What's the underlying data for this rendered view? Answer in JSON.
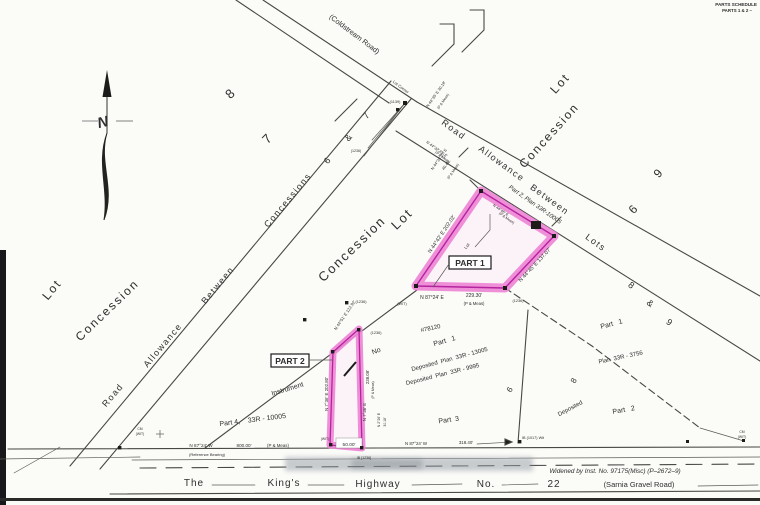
{
  "colors": {
    "highlight_band": "#ef86d6",
    "highlight_edge": "#b5239f",
    "highlight_fill": "#fdf3fa",
    "ink": "#2e2e2e",
    "paper": "#fbfbf8"
  },
  "labels": {
    "schedule_title": "PARTS SCHEDULE",
    "schedule_sub": "PARTS 1 & 2  –",
    "north": "N",
    "coldstream_road": "(Coldstream Road)",
    "cr_road": "Road",
    "cr_allowance": "Allowance",
    "cr_between": "Between",
    "cr_concessions": "Concessions",
    "cr_6": "6",
    "cr_amp": "&",
    "cr_7": "7",
    "lr_road": "Road",
    "lr_allowance": "Allowance",
    "lr_between": "Between",
    "lr_lots": "Lots",
    "lr_8": "8",
    "lr_amp": "&",
    "lr_9": "9",
    "road_parcel": "Part 2, Plan 33R-10005",
    "lot_corner": "Lot Corner",
    "mon_1139": "(1139)",
    "mon_1236_int": "(1236)",
    "tie_ne": "N 44°35' E  30.18'",
    "tie_ne_meas": "(P & Meas)",
    "tie_road1": "N 44°32'20\" E",
    "tie_road2": "(P & Meas)",
    "area_lot8": "8",
    "area_lot7": "7",
    "center_lot": "Lot",
    "center_concession": "Concession",
    "right_lot": "Lot",
    "right_concession": "Concession",
    "right_9": "9",
    "right_6": "6",
    "left_lot": "Lot",
    "left_concession": "Concession",
    "part1": "PART 1",
    "p1_left": "N 44°42' E   202.02'",
    "p1_tie1": "N 44°33'20\" E",
    "p1_tie2": "40.45'",
    "p1_tie3": "(P & Meas)",
    "p1_inner1": "N 44°45' E",
    "p1_inner2": "(P & Meas)",
    "p1_lot": "Lot",
    "p1_right": "N 44°45' E  137.07'",
    "p1_bot_bearing": "N 87°24' E",
    "p1_bot_dist": "229.30'",
    "p1_bot_meas": "(P & Meas)",
    "p1_bot_1236": "(1236)",
    "p1_bot_wit": "(WIT)",
    "part2": "PART 2",
    "p2_diag": "N 44°51' E  122.92'",
    "p2_left": "N 7°36' E  202.80'",
    "p2_right_dist": "238.08'",
    "p2_right_bearing": "N 7°36' E",
    "p2_right_meas": "(P & Meas)",
    "p2_tie_bearing": "N 2°26' E",
    "p2_tie_dist": "30.18'",
    "p2_bottom": "50.00'",
    "p2_1236a": "(1236)",
    "p2_1236b": "(1236)",
    "p2_ib": "IB [1236]",
    "p2_wit": "(WIT)",
    "instrument": "Instrument",
    "instrument_no": "No",
    "instrument_num": "#78120",
    "dep_part1": "Part   1",
    "dep_plan_13005": "Deposited  Plan  33R - 13005",
    "dep_plan_9995": "Deposited  Plan  33R - 9995",
    "part3": "Part  3",
    "rot6": "6",
    "part4": "Part 4,    33R - 10005",
    "rp_part1": "Part   1",
    "rp_plan": "Plan  33R - 3756",
    "rp_8": "8",
    "rp_deposited": "Deposited",
    "rp_part2": "Part   2",
    "hw_the": "The",
    "hw_kings": "King's",
    "hw_highway": "Highway",
    "hw_no": "No.",
    "hw_22": "22",
    "hw_sarnia": "(Sarnia Gravel Road)",
    "widened": "Widened by Inst. No. 97175(Misc) (P–2672–9)",
    "ref_bearing": "N 87°24' W",
    "ref_note": "(Reference Bearing)",
    "dist_800": "800.00'",
    "meas_800": "(P & Meas)",
    "dist_318": "318.40'",
    "ib_1017": "IB (1017) Wit",
    "right_bearing": "N 87°24' W",
    "cm_left": "CM",
    "wit_left": "(WIT)",
    "cm_right": "CM",
    "wit_right": "(WIT)"
  }
}
